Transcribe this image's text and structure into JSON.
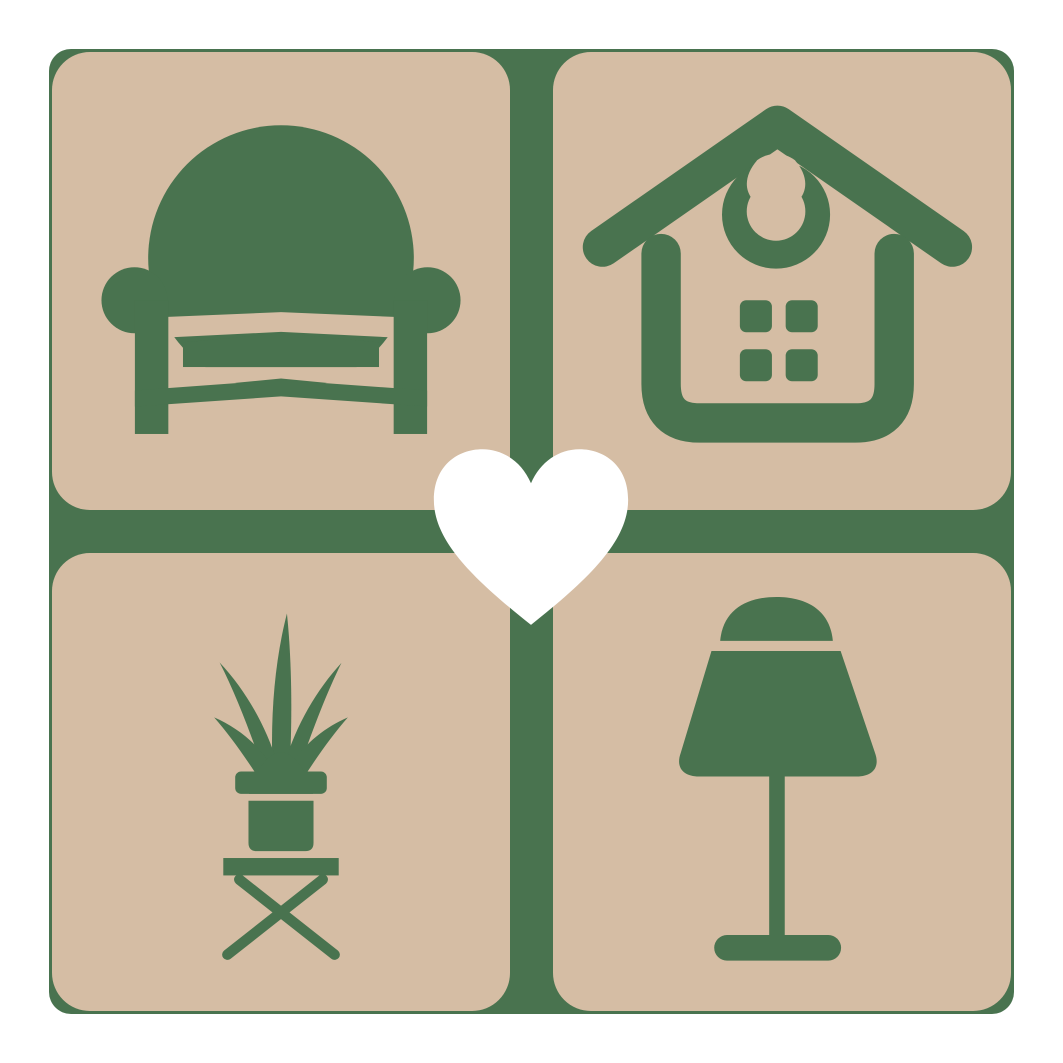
{
  "logo": {
    "name": "home-decor-heart-logo",
    "colors": {
      "background": "#ffffff",
      "tile_beige": "#d5bda4",
      "icon_green": "#49734f",
      "heart_white": "#ffffff"
    },
    "grid": {
      "rows": 2,
      "cols": 2,
      "gap_px": 43,
      "tile_radius_px": 38
    },
    "tiles": [
      {
        "position": "top-left",
        "icon": "armchair-icon"
      },
      {
        "position": "top-right",
        "icon": "house-icon"
      },
      {
        "position": "bottom-left",
        "icon": "potted-plant-icon"
      },
      {
        "position": "bottom-right",
        "icon": "table-lamp-icon"
      }
    ],
    "center_icon": "heart-icon"
  }
}
